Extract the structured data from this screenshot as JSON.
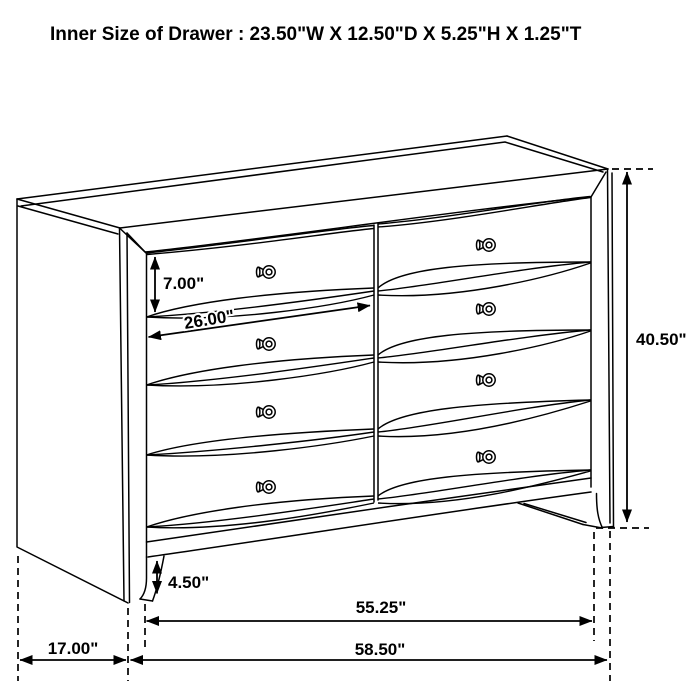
{
  "title": "Inner Size of Drawer : 23.50\"W X 12.50\"D X 5.25\"H X 1.25\"T",
  "dimensions": {
    "drawer_opening_height": "7.00\"",
    "drawer_width": "26.00\"",
    "overall_height": "40.50\"",
    "base_height": "4.50\"",
    "front_width": "55.25\"",
    "side_depth": "17.00\"",
    "overall_width": "58.50\""
  },
  "drawing": {
    "subject": "8-drawer dresser line drawing",
    "drawer_rows": 4,
    "drawer_columns": 2,
    "knob_count": 8
  },
  "colors": {
    "line": "#000000",
    "background": "#ffffff"
  }
}
